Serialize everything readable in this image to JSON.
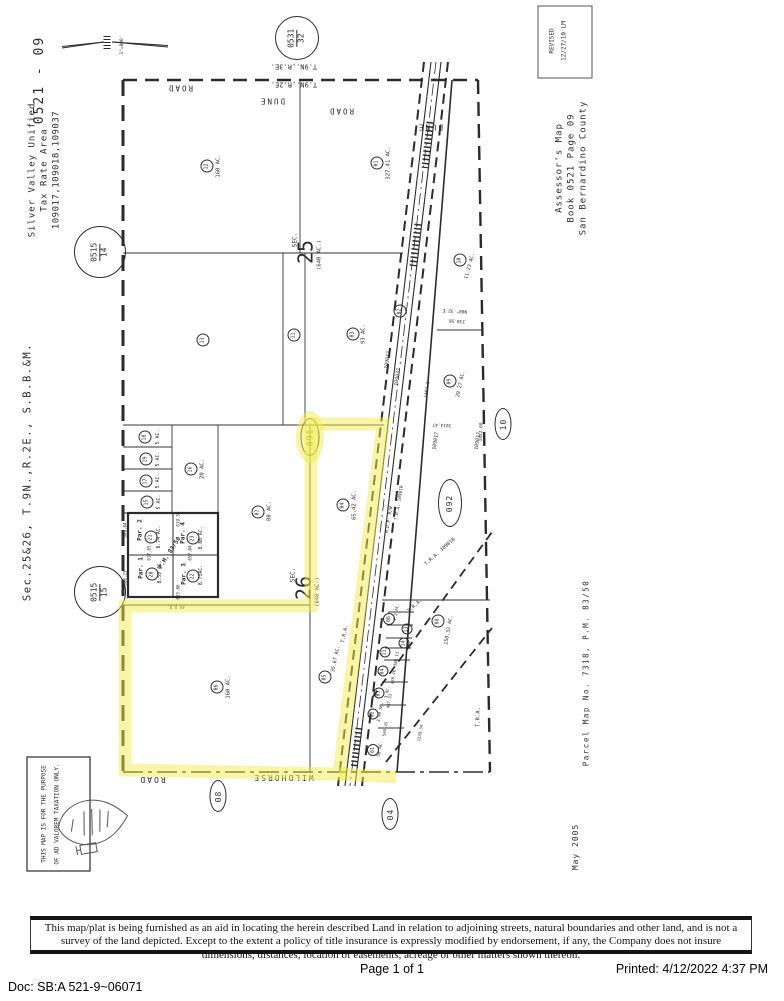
{
  "footer": {
    "doc": "Doc: SB:A 521-9~06071",
    "page": "Page 1 of 1",
    "printed": "Printed:  4/12/2022 4:37 PM"
  },
  "disclaimer": {
    "text": "This map/plat is being furnished as an aid in locating the herein described Land in relation to adjoining streets, natural boundaries and other land, and is not a survey of the land depicted. Except to the extent a policy of title insurance is expressly modified by endorsement, if any, the Company does not insure dimensions, distances, location of easements, acreage or other matters shown thereon."
  },
  "map": {
    "sheet_id": "0521 - 09",
    "scale": "1\"=800'",
    "highlight_color": "#f2ee4e",
    "texts": [
      {
        "t": "0521 - 09",
        "x": 40,
        "y": 80,
        "r": -90,
        "s": 13,
        "ls": 2
      },
      {
        "t": "Silver Valley Unified",
        "x": 33,
        "y": 170,
        "r": -90,
        "s": 9,
        "ls": 1
      },
      {
        "t": "Tax Rate Area",
        "x": 45,
        "y": 170,
        "r": -90,
        "s": 9,
        "ls": 1
      },
      {
        "t": "109017,109018,109037",
        "x": 57,
        "y": 170,
        "r": -90,
        "s": 9,
        "ls": 0.5
      },
      {
        "t": "Sec.25&26, T.9N.,R.2E., S.B.B.&M.",
        "x": 28,
        "y": 472,
        "r": -90,
        "s": 10.5,
        "ls": 1.5
      },
      {
        "t": "REVISED",
        "x": 552,
        "y": 41,
        "r": -90,
        "s": 6
      },
      {
        "t": "12/27/10 LM",
        "x": 564,
        "y": 41,
        "r": -90,
        "s": 6
      },
      {
        "t": "Assessor's Map",
        "x": 560,
        "y": 168,
        "r": -90,
        "s": 9,
        "ls": 1
      },
      {
        "t": "Book 0521 Page 09",
        "x": 572,
        "y": 168,
        "r": -90,
        "s": 9,
        "ls": 1
      },
      {
        "t": "San Bernardino County",
        "x": 584,
        "y": 168,
        "r": -90,
        "s": 9,
        "ls": 1
      },
      {
        "t": "Parcel Map No. 7318, P.M. 83/50",
        "x": 586,
        "y": 673,
        "r": -90,
        "s": 7.5,
        "ls": 1.5
      },
      {
        "t": "May 2005",
        "x": 576,
        "y": 847,
        "r": -90,
        "s": 8,
        "ls": 1
      },
      {
        "t": "THIS MAP IS FOR THE PURPOSE",
        "x": 44,
        "y": 814,
        "r": -90,
        "s": 6
      },
      {
        "t": "OF AD VALOREM TAXATION ONLY.",
        "x": 57,
        "y": 814,
        "r": -90,
        "s": 6
      },
      {
        "t": "1\"=800'",
        "x": 123,
        "y": 45,
        "r": -90,
        "s": 4.5
      },
      {
        "t": "T.9N.,R.3E.",
        "x": 294,
        "y": 66,
        "r": 180,
        "s": 7
      },
      {
        "t": "T.9N.,R.2E.",
        "x": 294,
        "y": 84,
        "r": 180,
        "s": 7
      },
      {
        "t": "ROAD",
        "x": 180,
        "y": 88,
        "r": 180,
        "s": 7.5,
        "ls": 2
      },
      {
        "t": "DUNE",
        "x": 272,
        "y": 101,
        "r": 180,
        "s": 7.5,
        "ls": 2
      },
      {
        "t": "ROAD",
        "x": 341,
        "y": 111,
        "r": 180,
        "s": 7.5,
        "ls": 2
      },
      {
        "t": "DUNE",
        "x": 430,
        "y": 127,
        "r": 180,
        "s": 7.5,
        "ls": 2
      },
      {
        "t": "160 AC.",
        "x": 219,
        "y": 166,
        "r": -90,
        "s": 5.5
      },
      {
        "t": "327.41 AC.",
        "x": 389,
        "y": 163,
        "r": -90,
        "s": 5.5
      },
      {
        "t": "93 AC.",
        "x": 364,
        "y": 334,
        "r": -90,
        "s": 5.5
      },
      {
        "t": "SEC.",
        "x": 295,
        "y": 240,
        "r": -90,
        "s": 6
      },
      {
        "t": "25",
        "x": 306,
        "y": 252,
        "r": -90,
        "s": 20
      },
      {
        "t": "(640 AC.)",
        "x": 320,
        "y": 255,
        "r": -90,
        "s": 5.5
      },
      {
        "t": "SEC.",
        "x": 293,
        "y": 575,
        "r": -90,
        "s": 6
      },
      {
        "t": "26",
        "x": 304,
        "y": 588,
        "r": -90,
        "s": 20
      },
      {
        "t": "(640 AC.)",
        "x": 318,
        "y": 592,
        "r": -90,
        "s": 5.5
      },
      {
        "t": "5 AC.",
        "x": 158,
        "y": 437,
        "r": -90,
        "s": 5
      },
      {
        "t": "5 AC.",
        "x": 158,
        "y": 459,
        "r": -90,
        "s": 5
      },
      {
        "t": "5 AC.",
        "x": 158,
        "y": 481,
        "r": -90,
        "s": 5
      },
      {
        "t": "5 AC.",
        "x": 159,
        "y": 502,
        "r": -90,
        "s": 5
      },
      {
        "t": "20 AC.",
        "x": 203,
        "y": 469,
        "r": -90,
        "s": 5.5
      },
      {
        "t": "80 AC.",
        "x": 270,
        "y": 511,
        "r": -90,
        "s": 5.5
      },
      {
        "t": "65.42 AC.",
        "x": 355,
        "y": 505,
        "r": -90,
        "s": 5.5
      },
      {
        "t": "160 AC.",
        "x": 229,
        "y": 687,
        "r": -90,
        "s": 5.5
      },
      {
        "t": "35.67 AC.",
        "x": 336,
        "y": 659,
        "r": -78,
        "s": 5
      },
      {
        "t": "T.R.A.",
        "x": 345,
        "y": 634,
        "r": -78,
        "s": 5
      },
      {
        "t": "150.32 AC.",
        "x": 449,
        "y": 630,
        "r": -80,
        "s": 5
      },
      {
        "t": "Par. 2",
        "x": 140,
        "y": 530,
        "r": -90,
        "s": 6,
        "b": 1
      },
      {
        "t": "Par. 4",
        "x": 183,
        "y": 533,
        "r": -90,
        "s": 6,
        "b": 1
      },
      {
        "t": "Par. 1",
        "x": 141,
        "y": 568,
        "r": -90,
        "s": 6,
        "b": 1
      },
      {
        "t": "Par. 3",
        "x": 184,
        "y": 574,
        "r": -90,
        "s": 6,
        "b": 1
      },
      {
        "t": "P.M. 83/50",
        "x": 170,
        "y": 553,
        "r": -58,
        "s": 6,
        "b": 1
      },
      {
        "t": "8.74 AC.",
        "x": 160,
        "y": 537,
        "r": -90,
        "s": 4.8
      },
      {
        "t": "8.88 AC.",
        "x": 202,
        "y": 538,
        "r": -90,
        "s": 4.8
      },
      {
        "t": "8.59 AC.",
        "x": 161,
        "y": 572,
        "r": -90,
        "s": 4.8
      },
      {
        "t": "8.71AC.",
        "x": 202,
        "y": 575,
        "r": -90,
        "s": 4.8
      },
      {
        "t": "609.04",
        "x": 125,
        "y": 530,
        "r": -90,
        "s": 4.2
      },
      {
        "t": "606.23",
        "x": 125,
        "y": 578,
        "r": -90,
        "s": 4.2
      },
      {
        "t": "619.51",
        "x": 178,
        "y": 519,
        "r": -90,
        "s": 4.2
      },
      {
        "t": "627.65",
        "x": 149,
        "y": 553,
        "r": -90,
        "s": 4.2
      },
      {
        "t": "657.04",
        "x": 190,
        "y": 553,
        "r": -90,
        "s": 4.2
      },
      {
        "t": "615.86",
        "x": 178,
        "y": 592,
        "r": -90,
        "s": 4.2
      },
      {
        "t": "40 D.D.",
        "x": 176,
        "y": 607,
        "r": 180,
        "s": 4.2
      },
      {
        "t": "WILDHORSE",
        "x": 283,
        "y": 777,
        "r": 180,
        "s": 8,
        "ls": 2
      },
      {
        "t": "ROAD",
        "x": 152,
        "y": 779,
        "r": 180,
        "s": 8,
        "ls": 2
      },
      {
        "t": "109017",
        "x": 388,
        "y": 360,
        "r": -81,
        "s": 5
      },
      {
        "t": "109037",
        "x": 398,
        "y": 377,
        "r": -81,
        "s": 5
      },
      {
        "t": "M.D.P. R/W",
        "x": 390,
        "y": 520,
        "r": -81,
        "s": 4.5
      },
      {
        "t": "T.R.A. 109018",
        "x": 400,
        "y": 503,
        "r": -81,
        "s": 4.5
      },
      {
        "t": "109017",
        "x": 436,
        "y": 441,
        "r": -81,
        "s": 5
      },
      {
        "t": "109017",
        "x": 478,
        "y": 441,
        "r": -81,
        "s": 5
      },
      {
        "t": "T.R.A. 109018",
        "x": 440,
        "y": 552,
        "r": -42,
        "s": 5
      },
      {
        "t": "T.R.A.",
        "x": 415,
        "y": 606,
        "r": -42,
        "s": 5
      },
      {
        "t": "T.R.A.",
        "x": 479,
        "y": 717,
        "r": -90,
        "s": 5.5
      },
      {
        "t": "N00°-32'E",
        "x": 455,
        "y": 310,
        "r": 183,
        "s": 4.5
      },
      {
        "t": "310.56",
        "x": 457,
        "y": 320,
        "r": 183,
        "s": 4.5
      },
      {
        "t": "1452.68",
        "x": 482,
        "y": 432,
        "r": -88,
        "s": 4.5
      },
      {
        "t": "1402.3",
        "x": 428,
        "y": 390,
        "r": -81,
        "s": 4.5
      },
      {
        "t": "1014.47",
        "x": 442,
        "y": 424,
        "r": 183,
        "s": 4.5
      },
      {
        "t": "11.23 AC.",
        "x": 470,
        "y": 266,
        "r": -75,
        "s": 5
      },
      {
        "t": "29.27 AC.",
        "x": 461,
        "y": 384,
        "r": -78,
        "s": 5
      },
      {
        "t": "7.2 AC.",
        "x": 396,
        "y": 612,
        "r": -80,
        "s": 4.2
      },
      {
        "t": "3 AC.",
        "x": 387,
        "y": 692,
        "r": -80,
        "s": 4.2
      },
      {
        "t": "3.99 AC.",
        "x": 380,
        "y": 712,
        "r": -80,
        "s": 4.2
      },
      {
        "t": "50 AC.",
        "x": 381,
        "y": 749,
        "r": -80,
        "s": 4.5
      },
      {
        "t": "388.13",
        "x": 396,
        "y": 659,
        "r": -80,
        "s": 4
      },
      {
        "t": "428.46",
        "x": 393,
        "y": 677,
        "r": -80,
        "s": 4
      },
      {
        "t": "437.33",
        "x": 389,
        "y": 701,
        "r": -80,
        "s": 4
      },
      {
        "t": "540.45",
        "x": 385,
        "y": 729,
        "r": -80,
        "s": 4
      },
      {
        "t": "1339.34",
        "x": 420,
        "y": 733,
        "r": -80,
        "s": 4
      }
    ],
    "parcel_circles": [
      {
        "n": "12",
        "x": 207,
        "y": 166
      },
      {
        "n": "01",
        "x": 377,
        "y": 163
      },
      {
        "n": "13",
        "x": 203,
        "y": 340
      },
      {
        "n": "11",
        "x": 294,
        "y": 335
      },
      {
        "n": "03",
        "x": 353,
        "y": 334
      },
      {
        "n": "02",
        "x": 400,
        "y": 311
      },
      {
        "n": "10",
        "x": 460,
        "y": 260
      },
      {
        "n": "09",
        "x": 450,
        "y": 381
      },
      {
        "n": "18",
        "x": 145,
        "y": 437
      },
      {
        "n": "19",
        "x": 146,
        "y": 459
      },
      {
        "n": "17",
        "x": 146,
        "y": 481
      },
      {
        "n": "15",
        "x": 147,
        "y": 502
      },
      {
        "n": "16",
        "x": 191,
        "y": 469
      },
      {
        "n": "07",
        "x": 258,
        "y": 512
      },
      {
        "n": "21",
        "x": 151,
        "y": 537
      },
      {
        "n": "23",
        "x": 193,
        "y": 538
      },
      {
        "n": "20",
        "x": 152,
        "y": 574
      },
      {
        "n": "22",
        "x": 193,
        "y": 576
      },
      {
        "n": "04",
        "x": 343,
        "y": 505
      },
      {
        "n": "06",
        "x": 217,
        "y": 687
      },
      {
        "n": "05",
        "x": 325,
        "y": 677
      },
      {
        "n": "08",
        "x": 438,
        "y": 621
      },
      {
        "n": "06",
        "x": 389,
        "y": 619,
        "d": 10
      },
      {
        "n": "13",
        "x": 407,
        "y": 629,
        "d": 9
      },
      {
        "n": "14",
        "x": 404,
        "y": 643,
        "d": 9
      },
      {
        "n": "11",
        "x": 385,
        "y": 652,
        "d": 9
      },
      {
        "n": "04",
        "x": 383,
        "y": 671,
        "d": 9
      },
      {
        "n": "03",
        "x": 379,
        "y": 693,
        "d": 9
      },
      {
        "n": "02",
        "x": 373,
        "y": 714,
        "d": 9
      },
      {
        "n": "01",
        "x": 373,
        "y": 750,
        "d": 10
      }
    ],
    "ref_ellipses": [
      {
        "t": "091",
        "x": 310,
        "y": 437,
        "w": 17,
        "h": 36
      },
      {
        "t": "092",
        "x": 450,
        "y": 503,
        "w": 22,
        "h": 46
      },
      {
        "t": "10",
        "x": 503,
        "y": 424,
        "w": 15,
        "h": 30
      },
      {
        "t": "08",
        "x": 218,
        "y": 796,
        "w": 15,
        "h": 30
      },
      {
        "t": "04",
        "x": 390,
        "y": 814,
        "w": 15,
        "h": 30
      }
    ],
    "ref_circles": [
      {
        "top": "0531",
        "bottom": "32",
        "x": 297,
        "y": 38,
        "d": 42
      },
      {
        "top": "0515",
        "bottom": "14",
        "x": 100,
        "y": 252,
        "d": 50
      },
      {
        "top": "0515",
        "bottom": "15",
        "x": 100,
        "y": 592,
        "d": 50
      }
    ]
  }
}
